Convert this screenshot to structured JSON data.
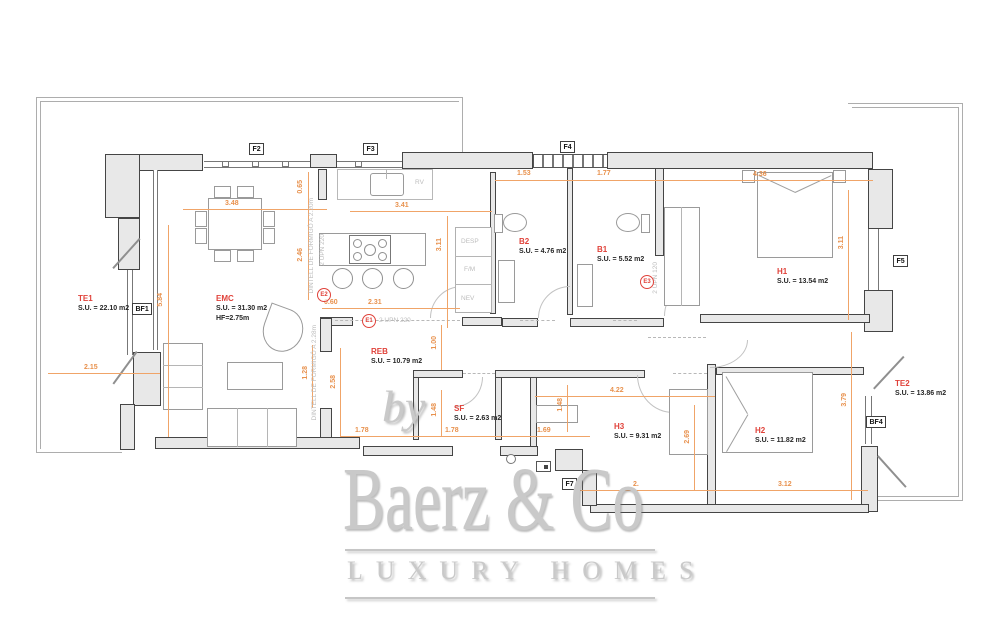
{
  "watermark": {
    "by": "by",
    "brand": "Baerz & Co",
    "tagline": "LUXURY HOMES"
  },
  "rooms": {
    "te1": {
      "name": "TE1",
      "area": "S.U. = 22.10 m2"
    },
    "emc": {
      "name": "EMC",
      "area": "S.U. = 31.30 m2",
      "height": "HF=2.75m"
    },
    "b2": {
      "name": "B2",
      "area": "S.U. = 4.76 m2"
    },
    "b1": {
      "name": "B1",
      "area": "S.U. = 5.52 m2"
    },
    "h1": {
      "name": "H1",
      "area": "S.U. = 13.54 m2"
    },
    "reb": {
      "name": "REB",
      "area": "S.U. = 10.79 m2"
    },
    "sf": {
      "name": "SF",
      "area": "S.U. = 2.63 m2"
    },
    "h3": {
      "name": "H3",
      "area": "S.U. = 9.31 m2"
    },
    "h2": {
      "name": "H2",
      "area": "S.U. = 11.82 m2"
    },
    "te2": {
      "name": "TE2",
      "area": "S.U. = 13.86 m2"
    }
  },
  "refs": {
    "f2": "F2",
    "f3": "F3",
    "f4": "F4",
    "f5": "F5",
    "f7": "F7",
    "bf1": "BF1",
    "bf4": "BF4"
  },
  "markers": {
    "e1": "E1",
    "e2": "E2",
    "e3": "E3"
  },
  "beams": {
    "dintell220": "DINTELL DE FORMIGÓ A 2.20m",
    "dintell228": "DINTELL DE FORMIGÓ A 2.28m",
    "upn220_v": "2 UPN 220",
    "upn220_h": "2 UPN 220",
    "upn120": "2 UPN 120"
  },
  "closet": {
    "rv": "RV",
    "desp": "DESP",
    "fm": "F/M",
    "nev": "NEV"
  },
  "dims": {
    "d348": "3.48",
    "d065": "0.65",
    "d246": "2.46",
    "d341": "3.41",
    "d311k": "3.11",
    "d153": "1.53",
    "d177": "1.77",
    "d436": "4.36",
    "d311h": "3.11",
    "d060": "0.60",
    "d231": "2.31",
    "d584": "5.84",
    "d215": "2.15",
    "d128": "1.28",
    "d258": "2.58",
    "d100": "1.00",
    "d148a": "1.48",
    "d148b": "1.48",
    "d178a": "1.78",
    "d178b": "1.78",
    "d169": "1.69",
    "d422": "4.22",
    "d269": "2.69",
    "d312": "3.12",
    "d2xx": "2.",
    "d379": "3.79"
  },
  "colors": {
    "dimension_text": "#e8914d",
    "dimension_line": "#f0a468",
    "room_name": "#e0423a",
    "area_text": "#262626",
    "wall_fill": "#e8e8e8",
    "wall_outline": "#454545",
    "beam_text": "#bdbdbd",
    "furn": "#9a9a9a",
    "watermark": "#c9c9c9"
  }
}
